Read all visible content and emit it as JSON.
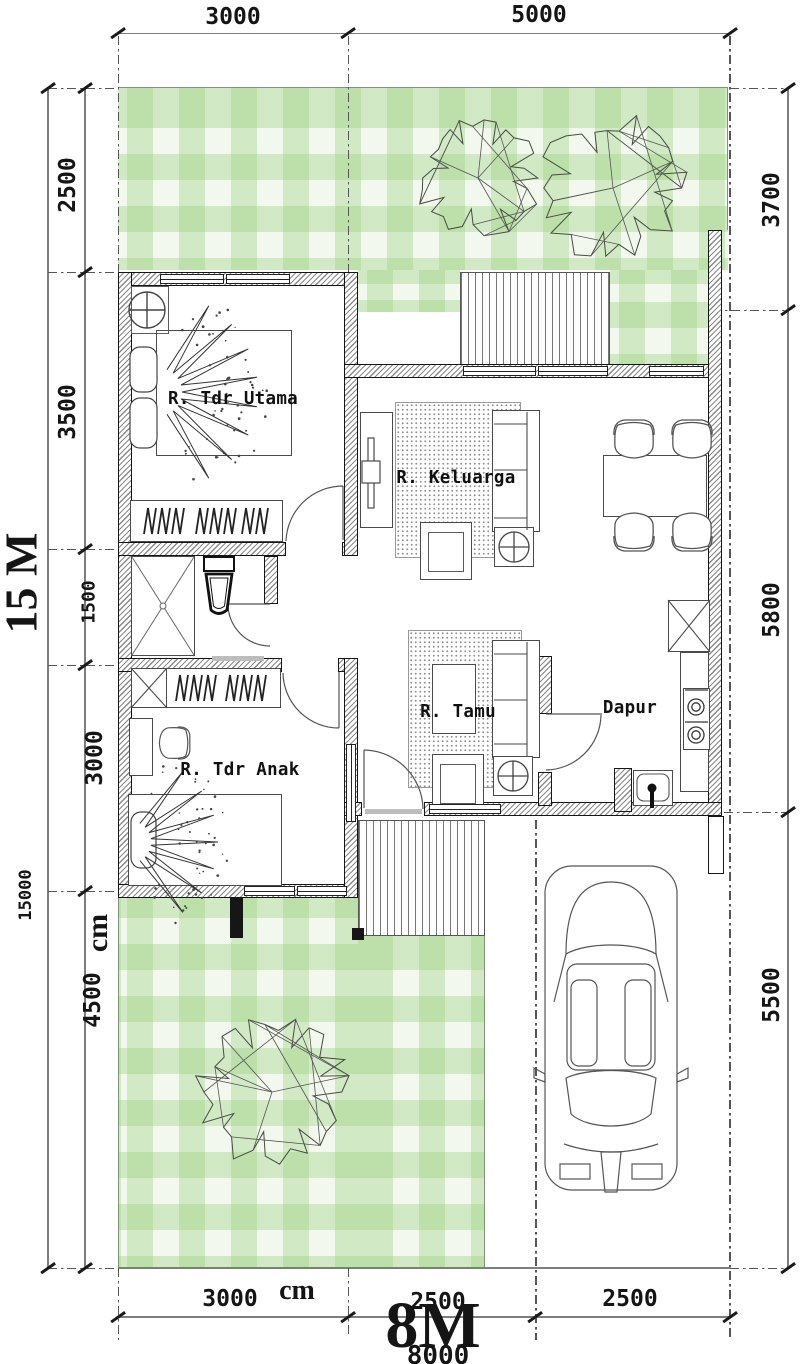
{
  "rooms": {
    "master": "R. Tdr Utama",
    "family": "R. Keluarga",
    "living": "R. Tamu",
    "kids": "R. Tdr Anak",
    "kitchen": "Dapur"
  },
  "dims": {
    "top": [
      "3000",
      "5000"
    ],
    "left": [
      "2500",
      "3500",
      "1500",
      "3000",
      "4500"
    ],
    "right": [
      "3700",
      "5800",
      "5500"
    ],
    "bottom": [
      "3000",
      "2500",
      "2500"
    ],
    "left_total": "15000",
    "bottom_total": "8000",
    "height_label": "15 M",
    "width_label": "8M",
    "unit_left": "cm",
    "unit_bottom": "cm"
  },
  "colors": {
    "lawn_band": "#bfe0a8",
    "wall_edge": "#151515",
    "line": "#555555",
    "text": "#111111"
  }
}
